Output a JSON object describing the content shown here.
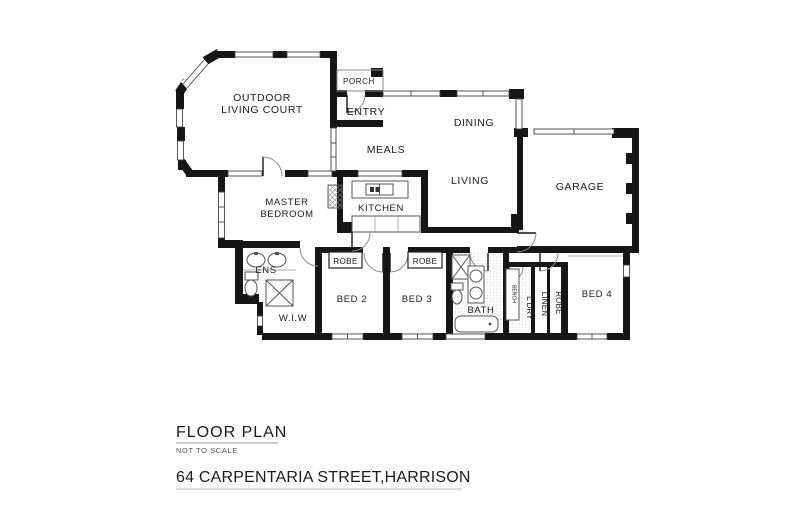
{
  "labels": {
    "outdoor_line1": "OUTDOOR",
    "outdoor_line2": "LIVING COURT",
    "porch": "PORCH",
    "entry": "ENTRY",
    "meals": "MEALS",
    "dining": "DINING",
    "living": "LIVING",
    "kitchen": "KITCHEN",
    "garage": "GARAGE",
    "master_line1": "MASTER",
    "master_line2": "BEDROOM",
    "ens": "ENS",
    "wiw": "W.I.W",
    "robe_bed2": "ROBE",
    "bed2": "BED 2",
    "robe_bed3": "ROBE",
    "bed3": "BED 3",
    "bath": "BATH",
    "bench": "BENCH",
    "ldry": "L'DRY",
    "linen": "LINEN",
    "robe_bed4": "ROBE",
    "bed4": "BED 4"
  },
  "title_block": {
    "title": "FLOOR PLAN",
    "scale_note": "NOT TO SCALE",
    "address": "64 CARPENTARIA STREET,HARRISON"
  },
  "colors": {
    "wall": "#161616",
    "line": "#555555",
    "background": "#ffffff"
  }
}
